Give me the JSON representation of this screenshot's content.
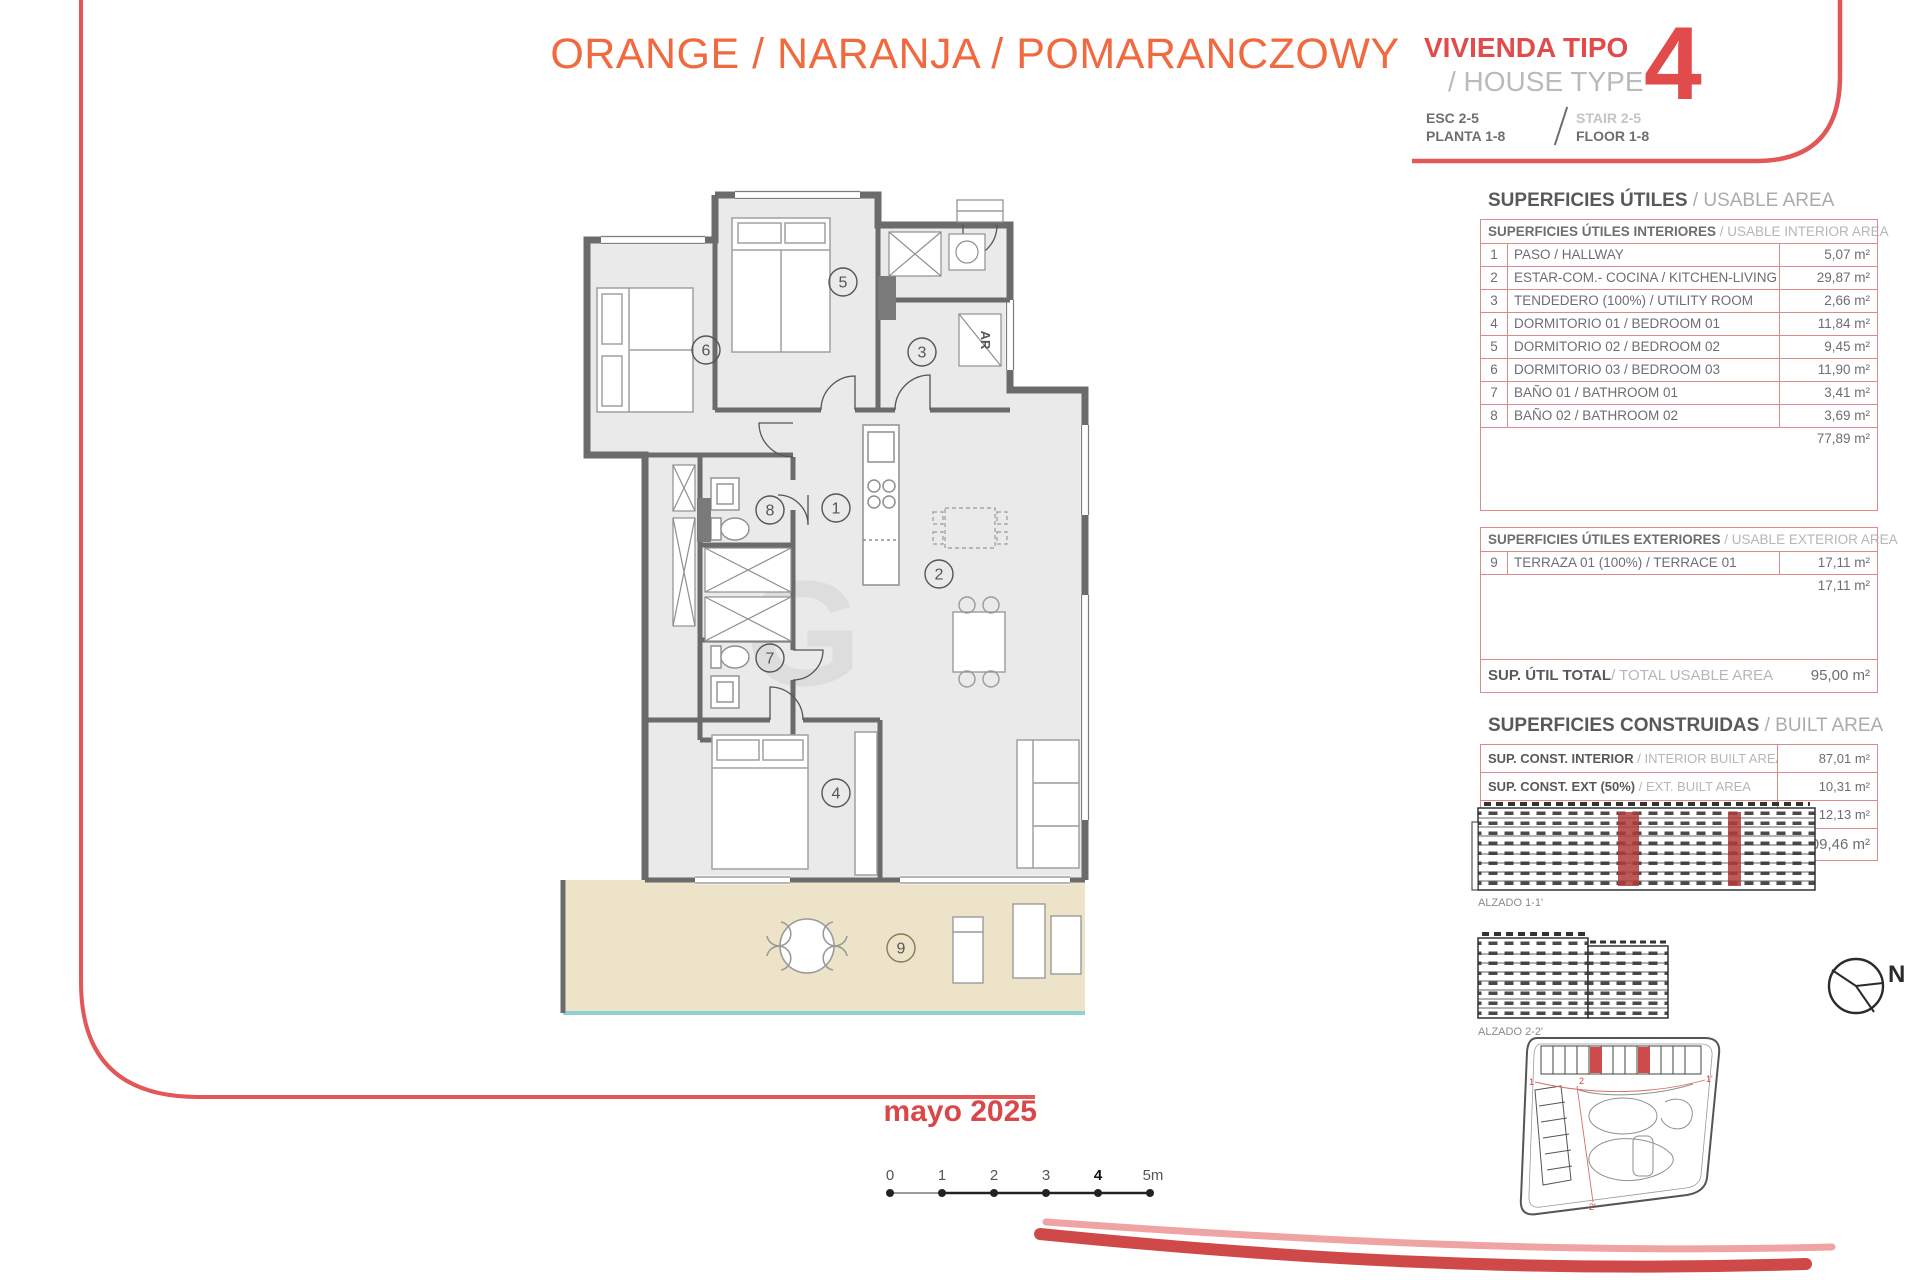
{
  "header": {
    "title_orange": "ORANGE / NARANJA / POMARANCZOWY",
    "vivienda_tipo": "VIVIENDA TIPO",
    "house_type": "/ HOUSE TYPE",
    "type_number": "4",
    "esc": "ESC 2-5",
    "planta": "PLANTA 1-8",
    "stair": "STAIR 2-5",
    "floor": "FLOOR 1-8"
  },
  "usable_area": {
    "title_es": "SUPERFICIES ÚTILES",
    "title_en": " / USABLE AREA",
    "interior": {
      "header_es": "SUPERFICIES ÚTILES INTERIORES",
      "header_en": " / USABLE INTERIOR AREA",
      "rows": [
        {
          "n": "1",
          "label": "PASO / HALLWAY",
          "value": "5,07 m²"
        },
        {
          "n": "2",
          "label": "ESTAR-COM.- COCINA / KITCHEN-LIVING",
          "value": "29,87 m²"
        },
        {
          "n": "3",
          "label": "TENDEDERO (100%) / UTILITY ROOM",
          "value": "2,66 m²"
        },
        {
          "n": "4",
          "label": "DORMITORIO 01 / BEDROOM 01",
          "value": "11,84 m²"
        },
        {
          "n": "5",
          "label": "DORMITORIO 02 / BEDROOM 02",
          "value": "9,45 m²"
        },
        {
          "n": "6",
          "label": "DORMITORIO 03 / BEDROOM 03",
          "value": "11,90 m²"
        },
        {
          "n": "7",
          "label": "BAÑO 01 / BATHROOM 01",
          "value": "3,41 m²"
        },
        {
          "n": "8",
          "label": "BAÑO 02 / BATHROOM 02",
          "value": "3,69 m²"
        }
      ],
      "subtotal": "77,89 m²"
    },
    "exterior": {
      "header_es": "SUPERFICIES ÚTILES EXTERIORES",
      "header_en": " / USABLE EXTERIOR AREA",
      "rows": [
        {
          "n": "9",
          "label": "TERRAZA 01 (100%) / TERRACE 01",
          "value": "17,11 m²"
        }
      ],
      "subtotal": "17,11 m²"
    },
    "total_label_es": "SUP. ÚTIL TOTAL",
    "total_label_en": " / TOTAL USABLE AREA",
    "total_value": "95,00 m²"
  },
  "built_area": {
    "title_es": "SUPERFICIES CONSTRUIDAS",
    "title_en": " / BUILT AREA",
    "rows": [
      {
        "es": "SUP. CONST. INTERIOR",
        "en": " / INTERIOR BUILT AREA",
        "value": "87,01 m²"
      },
      {
        "es": "SUP. CONST. EXT (50%)",
        "en": " / EXT. BUILT AREA",
        "value": "10,31 m²"
      },
      {
        "es": "SUP. CONST. Z/C",
        "en": " / BUILT AREA SHARED AREAS",
        "value": "12,13 m²"
      },
      {
        "es": "SUP. CONS. TOTAL",
        "en": " / TOTAL BUILT AREA",
        "value": "109,46 m²"
      }
    ]
  },
  "plan": {
    "room_numbers": [
      "1",
      "2",
      "3",
      "4",
      "5",
      "6",
      "7",
      "8",
      "9"
    ],
    "closet_label": "AR"
  },
  "elevations": {
    "alzado1": "ALZADO 1-1'",
    "alzado2": "ALZADO 2-2'"
  },
  "site_plan": {
    "markers": [
      "1",
      "1'",
      "2",
      "2'"
    ]
  },
  "compass": {
    "north": "N"
  },
  "date": "mayo 2025",
  "scale_bar": {
    "labels": [
      "0",
      "1",
      "2",
      "3",
      "4",
      "5m"
    ]
  },
  "colors": {
    "accent_red": "#e25757",
    "title_orange": "#f0693f",
    "dark_text": "#58595b",
    "light_text": "#a9abae",
    "table_border": "#d98b8b",
    "wall_gray": "#6b6b6b",
    "floor_gray": "#eaeaea",
    "terrace_beige": "#ece3c8",
    "glass_blue": "#8fd0d4",
    "highlight_red": "#c04646",
    "date_red": "#d84848"
  }
}
